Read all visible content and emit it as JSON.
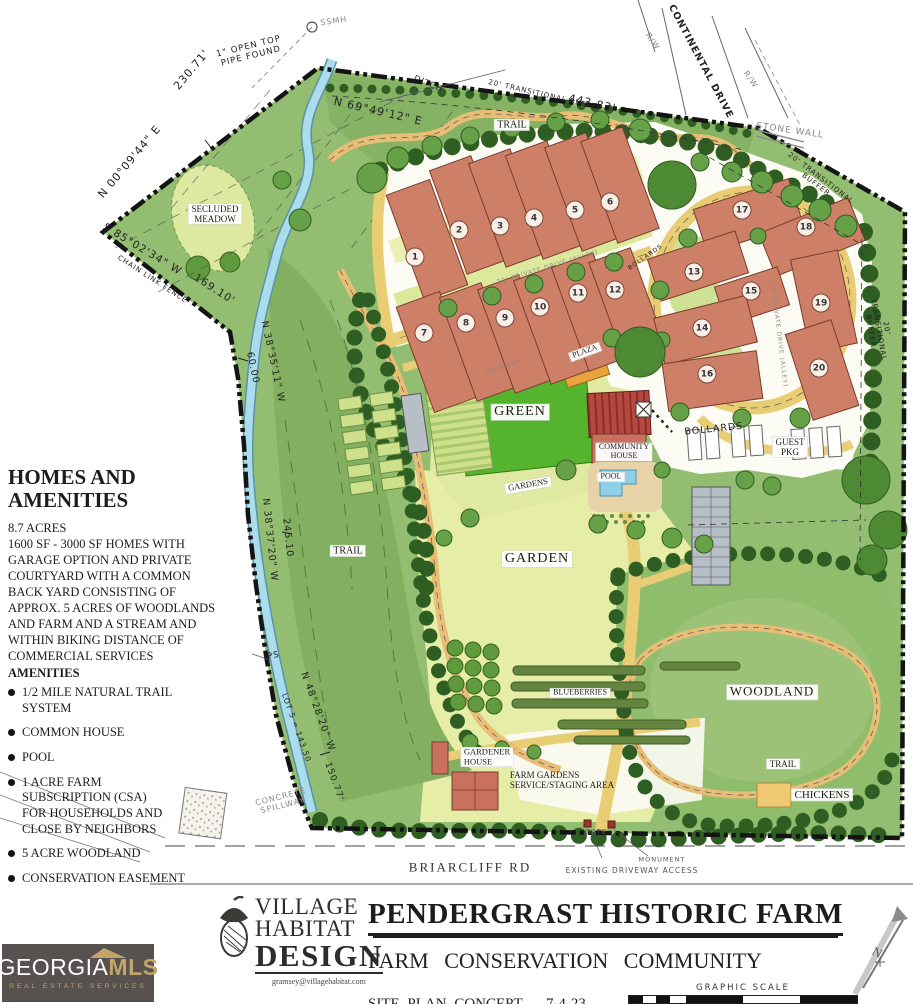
{
  "info_panel": {
    "heading": "HOMES AND\nAMENITIES",
    "paragraph": "8.7 ACRES\n1600 SF - 3000 SF HOMES WITH\nGARAGE OPTION AND PRIVATE\nCOURTYARD WITH A COMMON\nBACK YARD CONSISTING OF\nAPPROX. 5 ACRES OF WOODLANDS\nAND FARM AND A STREAM AND\nWITHIN BIKING DISTANCE OF\nCOMMERCIAL SERVICES",
    "amenities_heading": "AMENITIES",
    "amenities": [
      "1/2 MILE NATURAL TRAIL SYSTEM",
      "COMMON HOUSE",
      "POOL",
      "1  ACRE FARM\nSUBSCRIPTION (CSA)\nFOR HOUSEHOLDS AND\nCLOSE BY  NEIGHBORS",
      "5 ACRE WOODLAND",
      "CONSERVATION EASEMENT"
    ]
  },
  "plan": {
    "labels": {
      "secluded_meadow": "SECLUDED\nMEADOW",
      "trail": "TRAIL",
      "green": "GREEN",
      "plaza": "PLAZA",
      "community_house": "COMMUNITY\nHOUSE",
      "pool": "POOL",
      "gardens": "GARDENS",
      "garden": "GARDEN",
      "blueberries": "BLUEBERRIES",
      "woodland": "WOODLAND",
      "chickens": "CHICKENS",
      "gardener_house": "GARDENER\nHOUSE",
      "farm_gardens": "FARM GARDENS\nSERVICE/STAGING AREA",
      "bollards": "BOLLARDS",
      "guest_pkg": "GUEST\nPKG",
      "briarcliff_rd": "BRIARCLIFF RD",
      "continental_drive": "CONTINENTAL DRIVE",
      "stone_wall": "STONE WALL",
      "ditch": "DITCH",
      "ssmh": "SSMH",
      "transitional_buffer": "20' TRANSITIONAL BUFFER",
      "private_drive": "20' PRIVATE DRIVE (ALLEY)",
      "walkway": "WALKWAY",
      "gate": "GATE",
      "monument": "MONUMENT",
      "existing_driveway": "EXISTING DRIVEWAY ACCESS",
      "concrete_spillway": "CONCRETE\nSPILLWAY",
      "open_top_pipe": "1\" OPEN TOP\nPIPE FOUND",
      "chain_link_fence": "CHAIN LINK FENCE",
      "ips": "IPS",
      "rw": "R/W"
    },
    "survey": {
      "n6949": "N 69°49'12\" E",
      "d443": "443.83'",
      "n0009": "N 00°09'44\" E",
      "d230": "230.71'",
      "s8502": "S 85°02'34\" W",
      "d169": "169.10'",
      "n3835": "N 38°35'11\" W",
      "d60": "60.00",
      "n3837": "N 38°37'20\" W",
      "d245": "245.10",
      "n4828": "N 48°28'20\" W",
      "lot5": "LOT 5 = 143.50",
      "d150": "150.77'"
    },
    "houses": [
      "1",
      "2",
      "3",
      "4",
      "5",
      "6",
      "7",
      "8",
      "9",
      "10",
      "11",
      "12",
      "13",
      "14",
      "15",
      "16",
      "17",
      "18",
      "19",
      "20"
    ]
  },
  "title_block": {
    "project": "PENDERGRAST HISTORIC FARM",
    "subtitle": "FARM  CONSERVATION  COMMUNITY",
    "sheet": "SITE PLAN CONCEPT",
    "date": "7-4-23",
    "scale_label": "GRAPHIC SCALE",
    "scale_ticks": [
      "0",
      "20",
      "40",
      "80",
      "120",
      "160"
    ],
    "north": "N",
    "designer": {
      "line1": "VILLAGE",
      "line2": "HABITAT",
      "line3": "DESIGN",
      "email": "gramsey@villagehabitat.com"
    },
    "mls": {
      "brand_left": "GEORGIA",
      "brand_right": "MLS",
      "tagline": "REAL ESTATE SERVICES"
    }
  },
  "colors": {
    "boundary": "#141414",
    "building": "#cd7f68",
    "lawn_green": "#56b32e",
    "stream": "#aadcec",
    "road_yellow": "#e9cd74",
    "woodland_green": "#8fbd6c",
    "meadow_yellow": "#dde9a0",
    "chicken_swatch": "#eec873",
    "pool_blue": "#8fd0e8",
    "mls_gold": "#c2a569"
  }
}
